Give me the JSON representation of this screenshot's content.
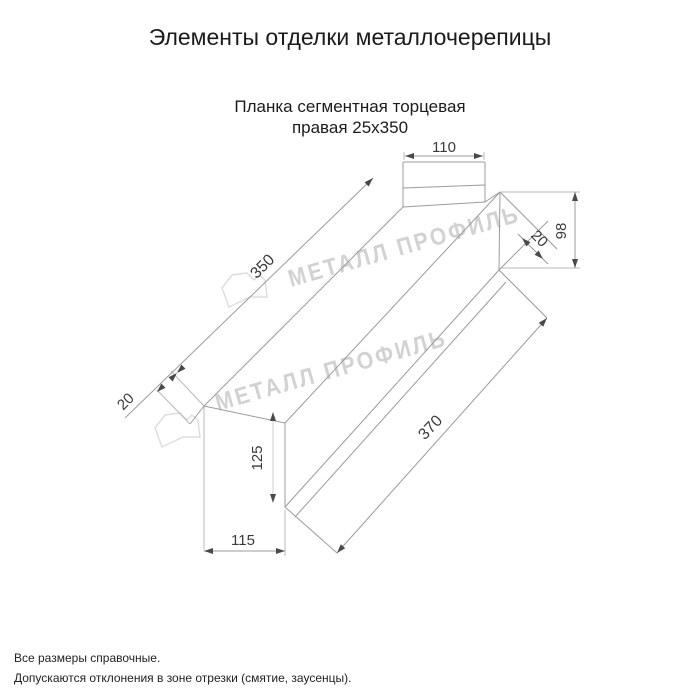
{
  "header": {
    "title": "Элементы отделки металлочерепицы",
    "subtitle_line1": "Планка сегментная торцевая",
    "subtitle_line2": "правая 25x350"
  },
  "watermark": {
    "text": "МЕТАЛЛ ПРОФИЛЬ",
    "color": "#d2d2d2"
  },
  "drawing": {
    "line_color": "#9b9b9b",
    "dims": {
      "top_flange_width": "110",
      "length_top": "350",
      "left_end_fold": "20",
      "right_height": "98",
      "right_fold": "20",
      "web_height": "125",
      "bottom_width": "115",
      "length_bottom": "370"
    }
  },
  "footnotes": {
    "line1": "Все размеры справочные.",
    "line2": "Допускаются отклонения в зоне отрезки (смятие, заусенцы)."
  }
}
